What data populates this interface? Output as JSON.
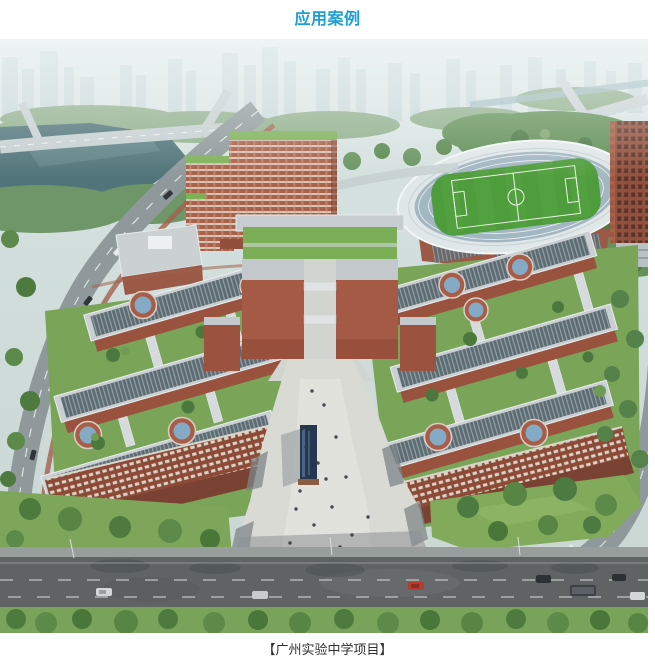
{
  "section": {
    "title": "应用案例",
    "caption": "【广州实验中学项目】"
  },
  "colors": {
    "title_text": "#1d9ed8",
    "caption_text": "#2f2f2f",
    "page_background": "#ffffff",
    "campus_brick": "#a05a44",
    "roof_panels": "#5d6b73",
    "stadium_field": "#4f9c3c",
    "lake_water": "#50747a",
    "asphalt_road": "#5f6364",
    "campus_grass": "#7aa458",
    "hazy_sky": "#d5e2e2"
  }
}
